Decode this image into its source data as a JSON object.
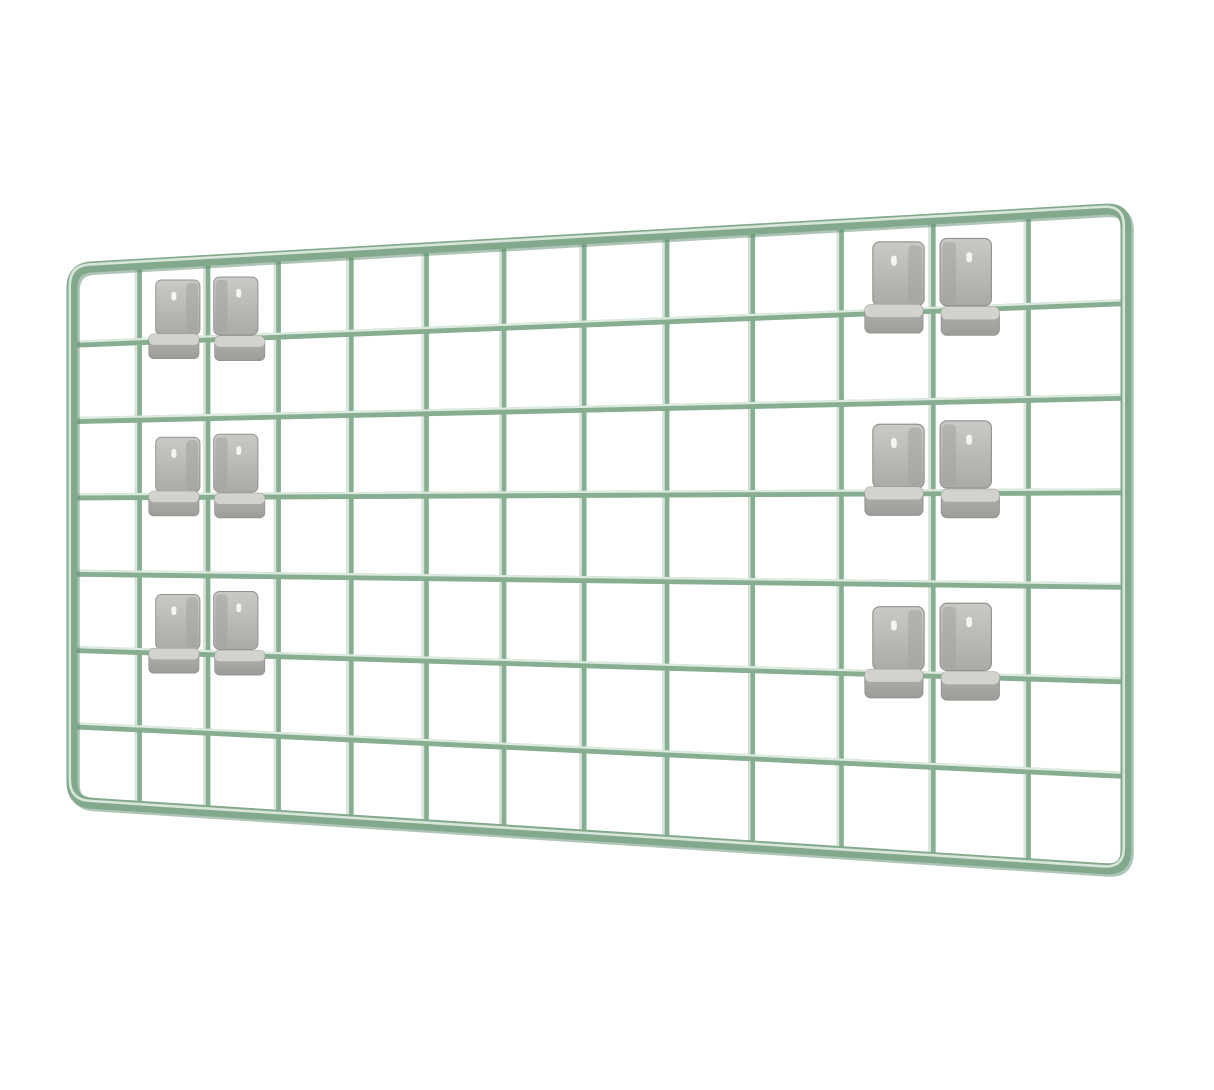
{
  "image": {
    "description": "Sage green wire grid panel photographed at a slight angle on a plain white background, with six pairs of grey plastic mounting clips hooked onto its wires",
    "background_color": "#ffffff"
  },
  "panel": {
    "columns": 13,
    "rows": 7,
    "corners": {
      "tl": [
        72,
        268
      ],
      "tr": [
        1126,
        208
      ],
      "br": [
        1126,
        870
      ],
      "bl": [
        72,
        802
      ]
    },
    "corner_radius": 20,
    "frame_stroke": 11,
    "wire_stroke": 7,
    "colors": {
      "wire": "#87ae91",
      "wire_dark": "#5e8a6e",
      "wire_light": "#e7f1e8",
      "frame": "#82a98c"
    }
  },
  "clips": {
    "colors": {
      "plate_light": "#cac9c5",
      "plate_dark": "#abaaa6",
      "plate_edge": "#93928e",
      "plate_seam": "#a3a29e",
      "lip_top": "#d3d2ce",
      "lip_light": "#b4b3af",
      "lip_dark": "#9d9c98",
      "highlight": "#fafaf8"
    },
    "positions": [
      {
        "col": 2,
        "row": 1
      },
      {
        "col": 2,
        "row": 3
      },
      {
        "col": 2,
        "row": 5
      },
      {
        "col": 11,
        "row": 1
      },
      {
        "col": 11,
        "row": 3
      },
      {
        "col": 11,
        "row": 5
      }
    ]
  }
}
